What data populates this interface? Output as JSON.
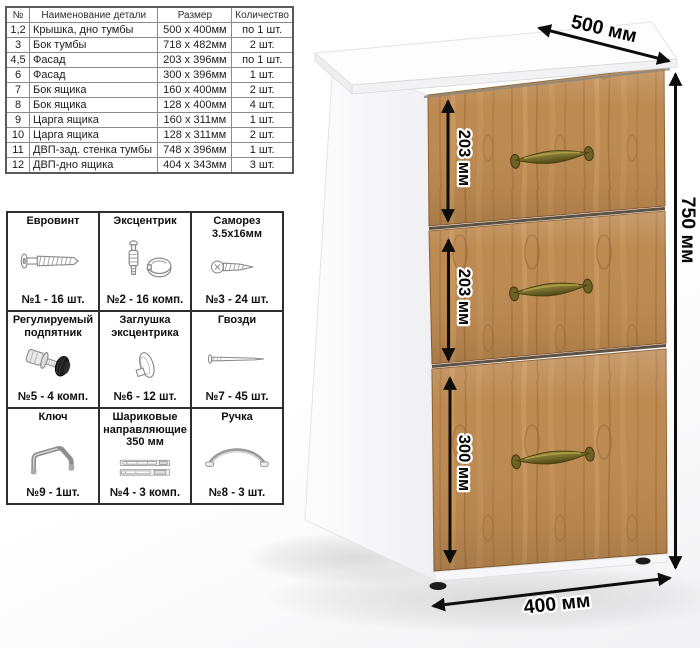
{
  "parts_table": {
    "headers": {
      "num": "№",
      "name": "Наименование детали",
      "size": "Размер",
      "qty": "Количество"
    },
    "rows": [
      {
        "num": "1,2",
        "name": "Крышка, дно тумбы",
        "size": "500 x 400мм",
        "qty": "по 1 шт."
      },
      {
        "num": "3",
        "name": "Бок тумбы",
        "size": "718 x 482мм",
        "qty": "2 шт."
      },
      {
        "num": "4,5",
        "name": "Фасад",
        "size": "203 x 396мм",
        "qty": "по 1 шт."
      },
      {
        "num": "6",
        "name": "Фасад",
        "size": "300 x 396мм",
        "qty": "1 шт."
      },
      {
        "num": "7",
        "name": "Бок ящика",
        "size": "160 x 400мм",
        "qty": "2 шт."
      },
      {
        "num": "8",
        "name": "Бок ящика",
        "size": "128 x 400мм",
        "qty": "4 шт."
      },
      {
        "num": "9",
        "name": "Царга ящика",
        "size": "160 x 311мм",
        "qty": "1 шт."
      },
      {
        "num": "10",
        "name": "Царга ящика",
        "size": "128 x 311мм",
        "qty": "2 шт."
      },
      {
        "num": "11",
        "name": "ДВП-зад. стенка тумбы",
        "size": "748 x 396мм",
        "qty": "1 шт."
      },
      {
        "num": "12",
        "name": "ДВП-дно ящика",
        "size": "404 x 343мм",
        "qty": "3 шт."
      }
    ]
  },
  "hardware_table": {
    "cells": [
      {
        "title": "Евровинт",
        "icon": "eurovint-screw-icon",
        "count": "№1 - 16 шт."
      },
      {
        "title": "Эксцентрик",
        "icon": "eccentric-cam-icon",
        "count": "№2 - 16 комп."
      },
      {
        "title": "Саморез 3.5х16мм",
        "icon": "self-tapping-screw-icon",
        "count": "№3 - 24 шт."
      },
      {
        "title": "Регулируемый подпятник",
        "icon": "adjustable-foot-icon",
        "count": "№5 - 4 комп."
      },
      {
        "title": "Заглушка эксцентрика",
        "icon": "cam-cover-icon",
        "count": "№6 - 12 шт."
      },
      {
        "title": "Гвозди",
        "icon": "nail-icon",
        "count": "№7 - 45 шт."
      },
      {
        "title": "Ключ",
        "icon": "hex-key-icon",
        "count": "№9 - 1шт."
      },
      {
        "title": "Шариковые направляющие 350 мм",
        "icon": "ball-bearing-slides-icon",
        "count": "№4 - 3 комп."
      },
      {
        "title": "Ручка",
        "icon": "bow-handle-icon",
        "count": "№8 - 3 шт."
      }
    ]
  },
  "cabinet": {
    "dim_labels": {
      "drawer1": "203 мм",
      "drawer2": "203 мм",
      "drawer3": "300 мм",
      "height": "750 мм",
      "depth": "500 мм",
      "width": "400 мм"
    },
    "colors": {
      "wood": "#bd8a52",
      "handle_brass": "#7b7030",
      "body_white": "#fbfbfc",
      "arrow": "#0d0d0d"
    }
  }
}
